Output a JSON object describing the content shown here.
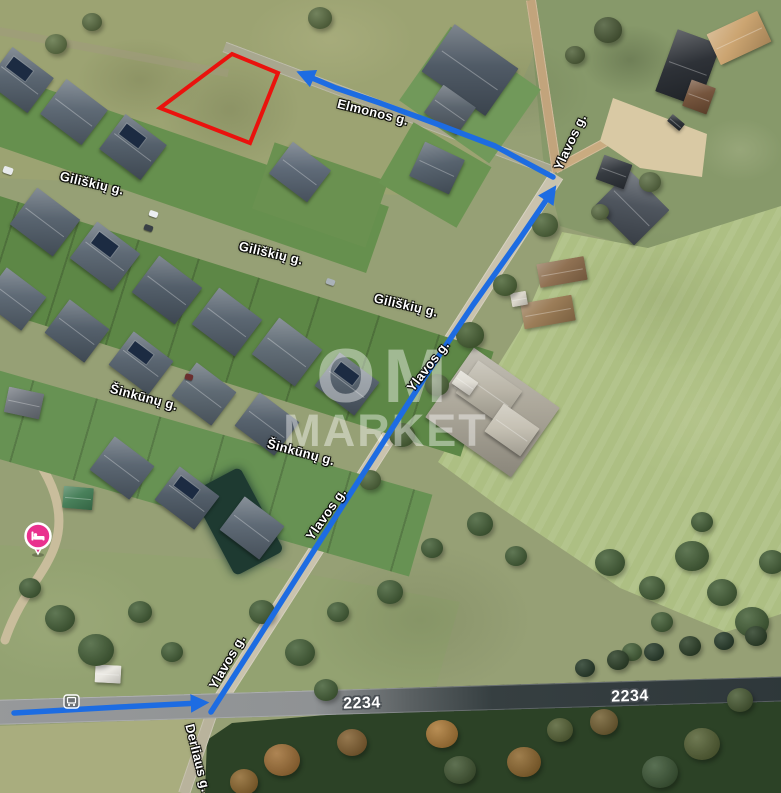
{
  "map": {
    "watermark": {
      "line1": "OM",
      "line2": "MARKET"
    },
    "street_labels": [
      {
        "name": "giliskiu-1",
        "text": "Giliškių g.",
        "x": 92,
        "y": 183,
        "rot": 13
      },
      {
        "name": "giliskiu-2",
        "text": "Giliškių g.",
        "x": 271,
        "y": 253,
        "rot": 13
      },
      {
        "name": "giliskiu-3",
        "text": "Giliškių g.",
        "x": 406,
        "y": 305,
        "rot": 13
      },
      {
        "name": "sinkunu-1",
        "text": "Šinkūnų g.",
        "x": 144,
        "y": 397,
        "rot": 15
      },
      {
        "name": "sinkunu-2",
        "text": "Šinkūnų g.",
        "x": 301,
        "y": 452,
        "rot": 15
      },
      {
        "name": "elmonos",
        "text": "Elmonos g.",
        "x": 373,
        "y": 112,
        "rot": 14
      },
      {
        "name": "ylavos-top",
        "text": "Ylavos g.",
        "x": 570,
        "y": 142,
        "rot": -65
      },
      {
        "name": "ylavos-mid",
        "text": "Ylavos g.",
        "x": 428,
        "y": 366,
        "rot": -52
      },
      {
        "name": "ylavos-low",
        "text": "Ylavos g.",
        "x": 326,
        "y": 514,
        "rot": -55
      },
      {
        "name": "ylavos-bottom",
        "text": "Ylavos g.",
        "x": 227,
        "y": 662,
        "rot": -60
      },
      {
        "name": "derliaus",
        "text": "Derliaus g.",
        "x": 198,
        "y": 758,
        "rot": 76
      }
    ],
    "road_labels": [
      {
        "name": "route-2234-left",
        "text": "2234",
        "x": 362,
        "y": 704,
        "rot": -2
      },
      {
        "name": "route-2234-right",
        "text": "2234",
        "x": 630,
        "y": 697,
        "rot": -2
      }
    ],
    "plot_outline": {
      "color": "#ea120d",
      "points": [
        [
          232,
          54
        ],
        [
          278,
          73
        ],
        [
          250,
          143
        ],
        [
          160,
          108
        ]
      ]
    },
    "route": {
      "color": "#1d6ce2",
      "segments": [
        {
          "name": "route-along-2234",
          "points": [
            [
              14,
              713
            ],
            [
              120,
              707
            ],
            [
              200,
              703
            ]
          ]
        },
        {
          "name": "route-ylavos",
          "points": [
            [
              211,
              712
            ],
            [
              252,
              648
            ],
            [
              313,
              552
            ],
            [
              372,
              460
            ],
            [
              432,
              366
            ],
            [
              473,
              305
            ],
            [
              519,
              240
            ],
            [
              551,
              193
            ]
          ]
        },
        {
          "name": "route-elmonos",
          "points": [
            [
              553,
              177
            ],
            [
              495,
              146
            ],
            [
              437,
              124
            ],
            [
              380,
              103
            ],
            [
              336,
              88
            ],
            [
              305,
              75
            ]
          ]
        }
      ]
    },
    "poi": {
      "name": "lodging-marker",
      "color": "#e9318e",
      "x": 38,
      "y": 536
    },
    "bus_stop": {
      "x": 71,
      "y": 701
    }
  },
  "houses": [
    {
      "x": 20,
      "y": 80,
      "w": 52,
      "h": 44,
      "rot": 37,
      "c": "#525e6a",
      "solar": true
    },
    {
      "x": 74,
      "y": 112,
      "w": 52,
      "h": 44,
      "rot": 37,
      "c": "#56626e"
    },
    {
      "x": 133,
      "y": 147,
      "w": 52,
      "h": 44,
      "rot": 37,
      "c": "#4c5864",
      "solar": true
    },
    {
      "x": 300,
      "y": 172,
      "w": 48,
      "h": 40,
      "rot": 37,
      "c": "#566270"
    },
    {
      "x": 437,
      "y": 168,
      "w": 44,
      "h": 38,
      "rot": 25,
      "c": "#4e5a66"
    },
    {
      "x": 45,
      "y": 222,
      "w": 54,
      "h": 46,
      "rot": 37,
      "c": "#505c68"
    },
    {
      "x": 105,
      "y": 256,
      "w": 54,
      "h": 46,
      "rot": 37,
      "c": "#56626e",
      "solar": true
    },
    {
      "x": 167,
      "y": 290,
      "w": 54,
      "h": 46,
      "rot": 37,
      "c": "#4a5662"
    },
    {
      "x": 227,
      "y": 322,
      "w": 54,
      "h": 46,
      "rot": 37,
      "c": "#525e6a"
    },
    {
      "x": 287,
      "y": 352,
      "w": 54,
      "h": 46,
      "rot": 37,
      "c": "#59656f"
    },
    {
      "x": 347,
      "y": 384,
      "w": 50,
      "h": 42,
      "rot": 37,
      "c": "#4e5a66",
      "solar": true
    },
    {
      "x": 14,
      "y": 299,
      "w": 50,
      "h": 42,
      "rot": 37,
      "c": "#56626e"
    },
    {
      "x": 77,
      "y": 331,
      "w": 50,
      "h": 42,
      "rot": 37,
      "c": "#4c5864"
    },
    {
      "x": 141,
      "y": 363,
      "w": 50,
      "h": 42,
      "rot": 37,
      "c": "#525e6a",
      "solar": true
    },
    {
      "x": 204,
      "y": 394,
      "w": 50,
      "h": 42,
      "rot": 37,
      "c": "#57636d"
    },
    {
      "x": 267,
      "y": 424,
      "w": 50,
      "h": 42,
      "rot": 37,
      "c": "#4e5a66"
    },
    {
      "x": 122,
      "y": 468,
      "w": 50,
      "h": 42,
      "rot": 37,
      "c": "#525e6a"
    },
    {
      "x": 187,
      "y": 498,
      "w": 50,
      "h": 42,
      "rot": 37,
      "c": "#4a5662",
      "solar": true
    },
    {
      "x": 252,
      "y": 528,
      "w": 50,
      "h": 42,
      "rot": 37,
      "c": "#56626e"
    },
    {
      "x": 470,
      "y": 70,
      "w": 78,
      "h": 58,
      "rot": 35,
      "c": "#47525e"
    },
    {
      "x": 450,
      "y": 110,
      "w": 40,
      "h": 34,
      "rot": 35,
      "c": "#525c66"
    },
    {
      "x": 632,
      "y": 208,
      "w": 56,
      "h": 50,
      "rot": 45,
      "c": "#454c55"
    },
    {
      "x": 614,
      "y": 172,
      "w": 30,
      "h": 26,
      "rot": 20,
      "c": "#2c3137"
    },
    {
      "x": 688,
      "y": 68,
      "w": 46,
      "h": 66,
      "rot": 20,
      "c": "#23272d"
    },
    {
      "x": 699,
      "y": 97,
      "w": 26,
      "h": 28,
      "rot": 20,
      "c": "#6e4c33"
    },
    {
      "x": 739,
      "y": 38,
      "w": 56,
      "h": 34,
      "rot": -25,
      "c": "#c9a06a"
    },
    {
      "x": 562,
      "y": 272,
      "w": 48,
      "h": 24,
      "rot": -10,
      "c": "#8a6a4a"
    },
    {
      "x": 548,
      "y": 312,
      "w": 52,
      "h": 26,
      "rot": -10,
      "c": "#96764f"
    },
    {
      "x": 519,
      "y": 299,
      "w": 16,
      "h": 14,
      "rot": -10,
      "c": "#d9d5c9"
    },
    {
      "x": 492,
      "y": 412,
      "w": 105,
      "h": 85,
      "rot": 35,
      "c": "#a8a395"
    },
    {
      "x": 489,
      "y": 392,
      "w": 54,
      "h": 40,
      "rot": 35,
      "c": "#b7b2a4"
    },
    {
      "x": 512,
      "y": 430,
      "w": 44,
      "h": 34,
      "rot": 35,
      "c": "#c3beb0"
    },
    {
      "x": 465,
      "y": 383,
      "w": 22,
      "h": 16,
      "rot": 35,
      "c": "#dedbd2"
    },
    {
      "x": 108,
      "y": 674,
      "w": 26,
      "h": 18,
      "rot": 3,
      "c": "#e9e7e0"
    },
    {
      "x": 78,
      "y": 498,
      "w": 30,
      "h": 22,
      "rot": 5,
      "c": "#3f7a52"
    },
    {
      "x": 24,
      "y": 403,
      "w": 36,
      "h": 26,
      "rot": 12,
      "c": "#6a7078"
    },
    {
      "x": 676,
      "y": 122,
      "w": 16,
      "h": 9,
      "rot": 40,
      "c": "#23282e"
    }
  ],
  "trees": [
    {
      "x": 60,
      "y": 618,
      "r": 15
    },
    {
      "x": 96,
      "y": 650,
      "r": 18
    },
    {
      "x": 140,
      "y": 612,
      "r": 12
    },
    {
      "x": 30,
      "y": 588,
      "r": 11
    },
    {
      "x": 172,
      "y": 652,
      "r": 11
    },
    {
      "x": 262,
      "y": 612,
      "r": 13
    },
    {
      "x": 300,
      "y": 652,
      "r": 15
    },
    {
      "x": 338,
      "y": 612,
      "r": 11
    },
    {
      "x": 390,
      "y": 592,
      "r": 13
    },
    {
      "x": 432,
      "y": 548,
      "r": 11
    },
    {
      "x": 326,
      "y": 690,
      "r": 12
    },
    {
      "x": 480,
      "y": 524,
      "r": 13
    },
    {
      "x": 516,
      "y": 556,
      "r": 11
    },
    {
      "x": 610,
      "y": 562,
      "r": 15
    },
    {
      "x": 652,
      "y": 588,
      "r": 13
    },
    {
      "x": 692,
      "y": 556,
      "r": 17
    },
    {
      "x": 722,
      "y": 592,
      "r": 15
    },
    {
      "x": 752,
      "y": 622,
      "r": 17
    },
    {
      "x": 772,
      "y": 562,
      "r": 13
    },
    {
      "x": 702,
      "y": 522,
      "r": 11
    },
    {
      "x": 662,
      "y": 622,
      "r": 11
    },
    {
      "x": 632,
      "y": 652,
      "r": 10
    },
    {
      "x": 545,
      "y": 225,
      "r": 13,
      "c": "#4a6334"
    },
    {
      "x": 505,
      "y": 285,
      "r": 12,
      "c": "#46602f"
    },
    {
      "x": 470,
      "y": 335,
      "r": 14,
      "c": "#415c2c"
    },
    {
      "x": 437,
      "y": 385,
      "r": 12,
      "c": "#4a6334"
    },
    {
      "x": 402,
      "y": 435,
      "r": 13,
      "c": "#445e2e"
    },
    {
      "x": 370,
      "y": 480,
      "r": 11,
      "c": "#4a6334"
    },
    {
      "x": 320,
      "y": 18,
      "r": 12,
      "c": "#54683a"
    },
    {
      "x": 92,
      "y": 22,
      "r": 10,
      "c": "#54683a"
    },
    {
      "x": 56,
      "y": 44,
      "r": 11,
      "c": "#5a6f3e"
    },
    {
      "x": 650,
      "y": 182,
      "r": 11,
      "c": "#55683c"
    },
    {
      "x": 600,
      "y": 212,
      "r": 9,
      "c": "#55683c"
    },
    {
      "x": 608,
      "y": 30,
      "r": 14,
      "c": "#44552f"
    },
    {
      "x": 575,
      "y": 55,
      "r": 10,
      "c": "#4a5c32"
    },
    {
      "x": 585,
      "y": 668,
      "r": 10,
      "c": "#1f3522"
    },
    {
      "x": 618,
      "y": 660,
      "r": 11,
      "c": "#24391f"
    },
    {
      "x": 654,
      "y": 652,
      "r": 10,
      "c": "#1f3522"
    },
    {
      "x": 690,
      "y": 646,
      "r": 11,
      "c": "#24391f"
    },
    {
      "x": 724,
      "y": 641,
      "r": 10,
      "c": "#1f3522"
    },
    {
      "x": 756,
      "y": 636,
      "r": 11,
      "c": "#24391f"
    },
    {
      "x": 282,
      "y": 760,
      "r": 18,
      "c": "#9c6a2e"
    },
    {
      "x": 352,
      "y": 742,
      "r": 15,
      "c": "#7e5a28"
    },
    {
      "x": 442,
      "y": 734,
      "r": 16,
      "c": "#a9752f"
    },
    {
      "x": 524,
      "y": 762,
      "r": 17,
      "c": "#8a6226"
    },
    {
      "x": 604,
      "y": 722,
      "r": 14,
      "c": "#6e5a2a"
    },
    {
      "x": 702,
      "y": 744,
      "r": 18,
      "c": "#4f5c2d"
    },
    {
      "x": 244,
      "y": 782,
      "r": 14,
      "c": "#8a6226"
    },
    {
      "x": 460,
      "y": 770,
      "r": 16,
      "c": "#3c522c"
    },
    {
      "x": 660,
      "y": 772,
      "r": 18,
      "c": "#35512e"
    },
    {
      "x": 560,
      "y": 730,
      "r": 13,
      "c": "#4f5c2d"
    },
    {
      "x": 740,
      "y": 700,
      "r": 13,
      "c": "#42552c"
    }
  ],
  "cars": [
    {
      "x": 153,
      "y": 214,
      "w": 9,
      "h": 6,
      "rot": 19,
      "c": "#eceff1"
    },
    {
      "x": 148,
      "y": 228,
      "w": 9,
      "h": 6,
      "rot": 19,
      "c": "#394046"
    },
    {
      "x": 330,
      "y": 282,
      "w": 9,
      "h": 6,
      "rot": 19,
      "c": "#aab2b8"
    },
    {
      "x": 189,
      "y": 377,
      "w": 8,
      "h": 6,
      "rot": 16,
      "c": "#6b2f2f"
    },
    {
      "x": 8,
      "y": 170,
      "w": 10,
      "h": 7,
      "rot": 19,
      "c": "#e8eaec"
    }
  ]
}
